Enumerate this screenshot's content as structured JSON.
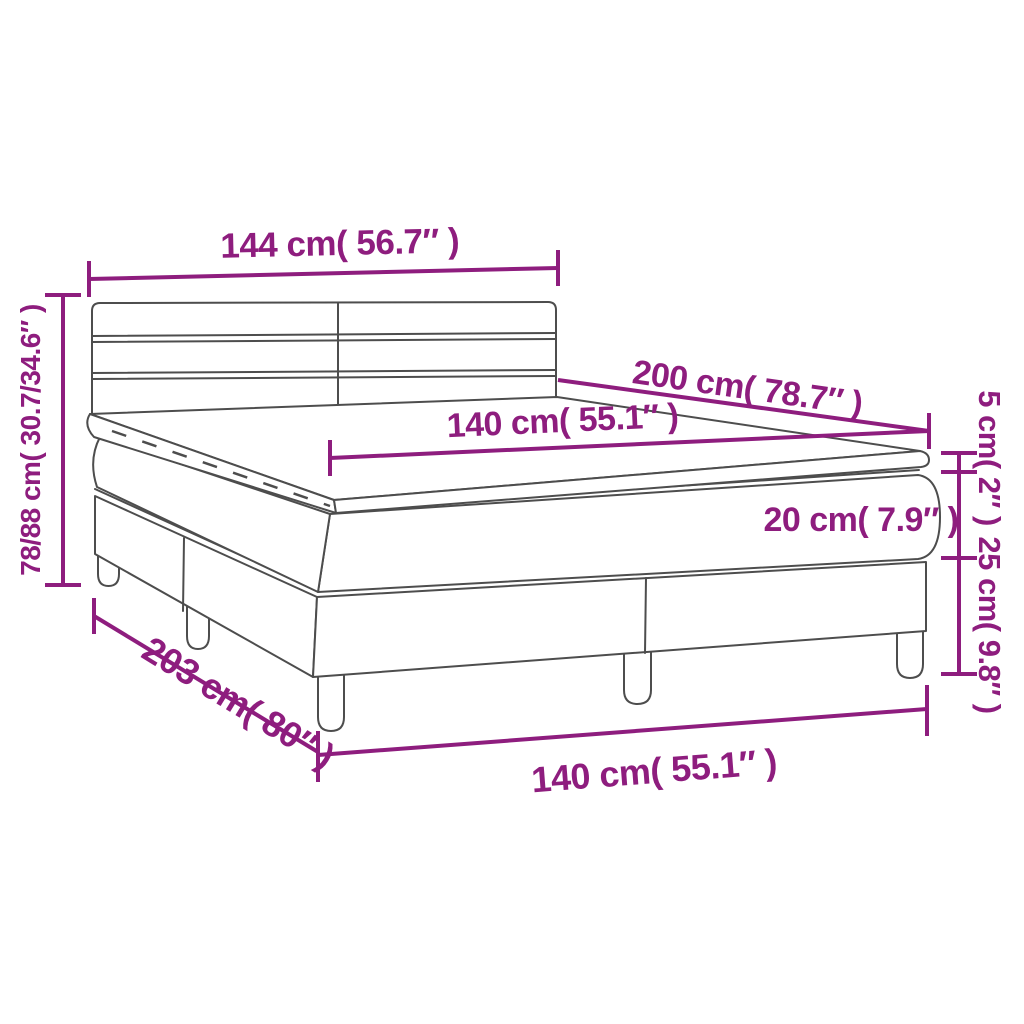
{
  "diagram": {
    "kind": "product-dimension-diagram",
    "subject": "box spring bed with striped headboard, mattress and topper",
    "colors": {
      "dimension_accent": "#8e1d7e",
      "line_art": "#4d4d4d",
      "background": "#ffffff"
    },
    "labels": {
      "headboard_width": "144 cm( 56.7″ )",
      "overall_height": "78/88 cm( 30.7/34.6″ )",
      "mattress_length": "200 cm( 78.7″ )",
      "mattress_width": "140 cm( 55.1″ )",
      "topper_thickness": "5 cm( 2″ )",
      "mattress_thickness": "20 cm( 7.9″ )",
      "base_height": "25 cm( 9.8″ )",
      "base_length": "203 cm( 80″ )",
      "base_width": "140 cm( 55.1″ )"
    }
  }
}
